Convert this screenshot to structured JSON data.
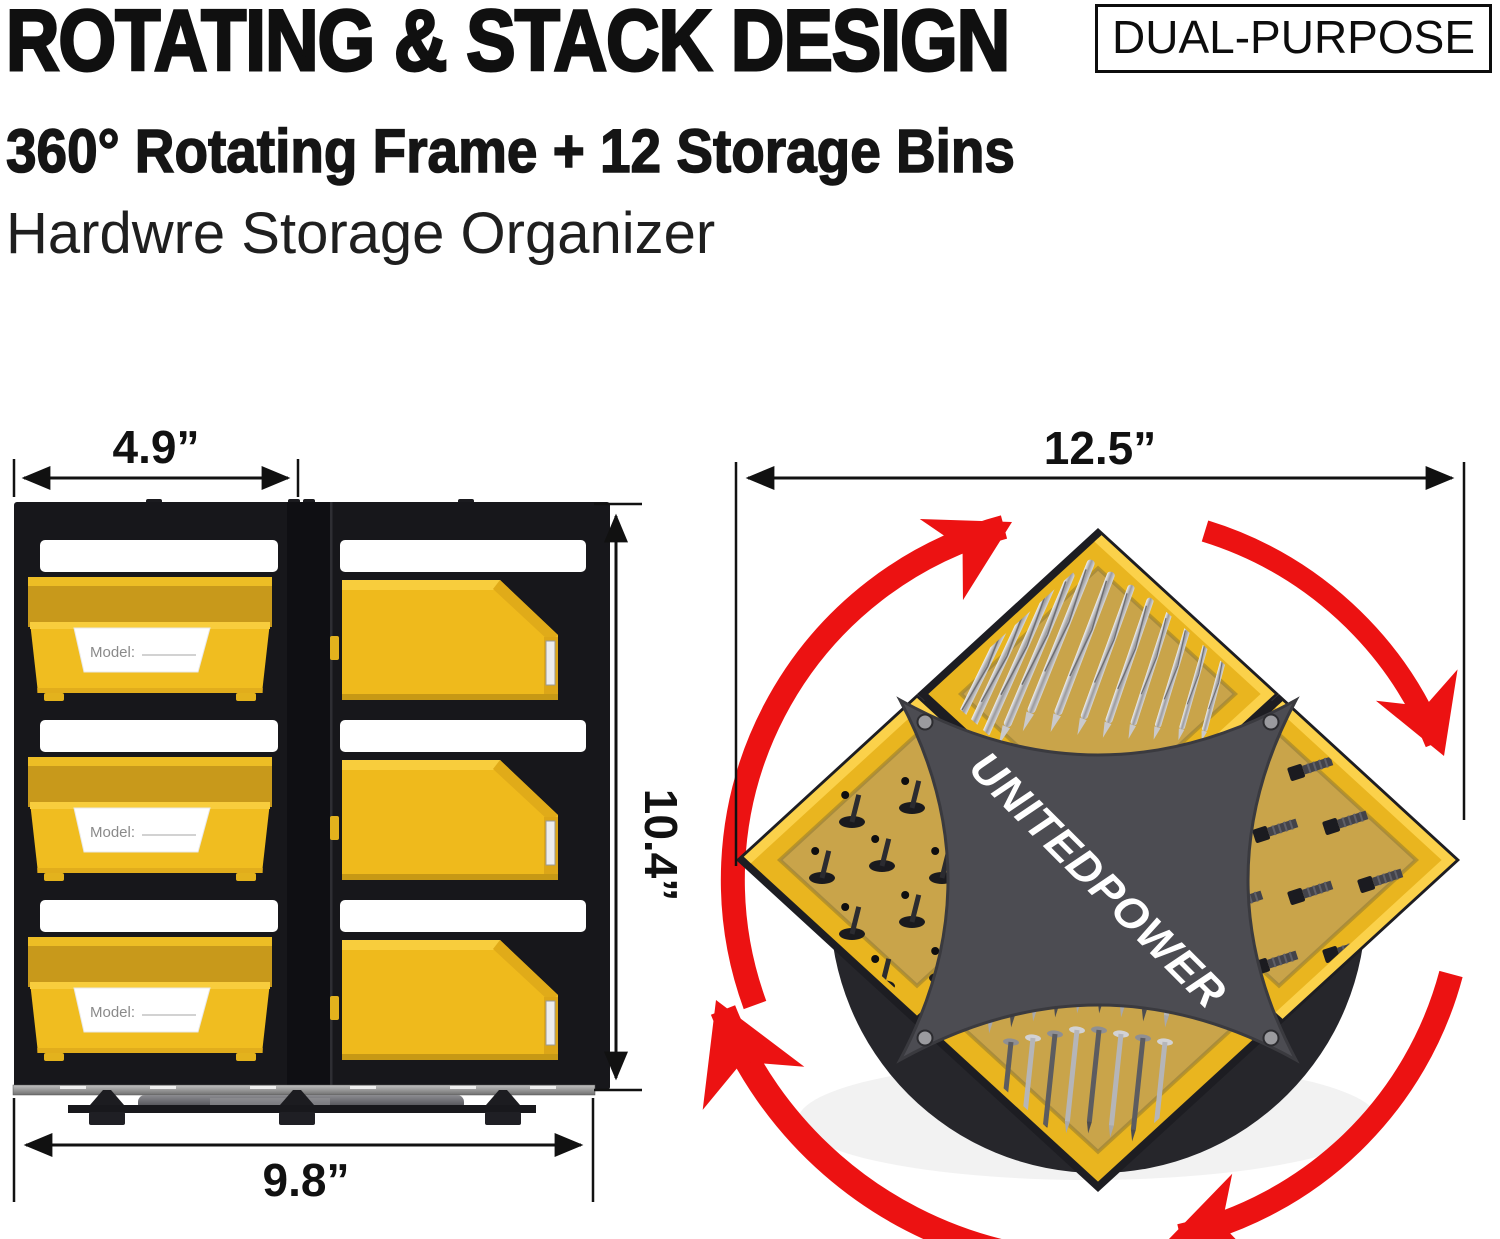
{
  "header": {
    "title": "ROTATING & STACK DESIGN",
    "badge": "DUAL-PURPOSE",
    "subtitle": "360° Rotating Frame + 12 Storage Bins",
    "tagline": "Hardwre Storage Organizer"
  },
  "front_view": {
    "dim_width_half": "4.9”",
    "dim_width": "9.8”",
    "dim_height": "10.4”",
    "bin_label": "Model:",
    "bin_rows": 3,
    "bin_columns": 2
  },
  "top_view": {
    "dim_width": "12.5”",
    "brand": "UNITEDPOWER",
    "bins_shown": 4,
    "contents": [
      "drill-bits",
      "pan-head-screws",
      "hex-bolts",
      "wood-screws"
    ]
  },
  "colors": {
    "bin_yellow": "#F0BD20",
    "bin_yellow_light": "#F8CD3D",
    "bin_yellow_dark": "#D9A41A",
    "bin_interior": "#C8991B",
    "tray_interior": "#C9A44A",
    "frame_black": "#17171B",
    "rotation_arrow_red": "#EC1212",
    "turntable_gray": "#26262B",
    "hub_plate_gray": "#4C4C52",
    "text_black": "#111111"
  }
}
